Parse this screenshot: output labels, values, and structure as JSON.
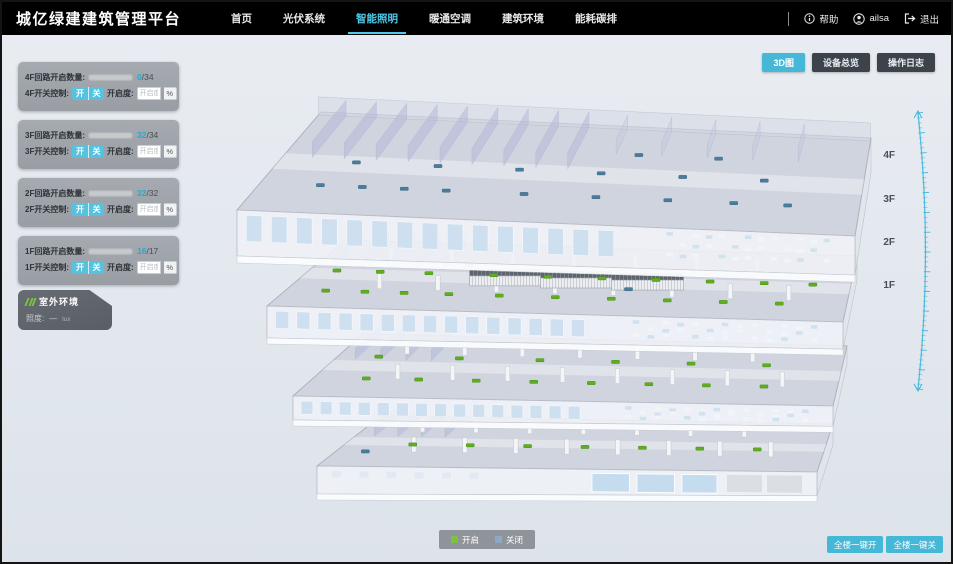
{
  "header": {
    "title": "城亿绿建建筑管理平台",
    "nav": [
      {
        "label": "首页",
        "active": false
      },
      {
        "label": "光伏系统",
        "active": false
      },
      {
        "label": "智能照明",
        "active": true
      },
      {
        "label": "暖通空调",
        "active": false
      },
      {
        "label": "建筑环境",
        "active": false
      },
      {
        "label": "能耗碳排",
        "active": false
      }
    ],
    "help_label": "帮助",
    "username": "ailsa",
    "logout_label": "退出"
  },
  "view_buttons": [
    {
      "label": "3D图",
      "active": true
    },
    {
      "label": "设备总览",
      "active": false
    },
    {
      "label": "操作日志",
      "active": false
    }
  ],
  "floor_panels": [
    {
      "count_label": "4F回路开启数量:",
      "count_open": "0",
      "count_rest": "/34",
      "progress": 0,
      "switch_label": "4F开关控制:",
      "on_label": "开",
      "off_label": "关",
      "dim_label": "开启度:",
      "dim_placeholder": "开启度",
      "percent_label": "%"
    },
    {
      "count_label": "3F回路开启数量:",
      "count_open": "32",
      "count_rest": "/34",
      "progress": 0.94,
      "switch_label": "3F开关控制:",
      "on_label": "开",
      "off_label": "关",
      "dim_label": "开启度:",
      "dim_placeholder": "开启度",
      "percent_label": "%"
    },
    {
      "count_label": "2F回路开启数量:",
      "count_open": "32",
      "count_rest": "/32",
      "progress": 1,
      "switch_label": "2F开关控制:",
      "on_label": "开",
      "off_label": "关",
      "dim_label": "开启度:",
      "dim_placeholder": "开启度",
      "percent_label": "%"
    },
    {
      "count_label": "1F回路开启数量:",
      "count_open": "16",
      "count_rest": "/17",
      "progress": 0.94,
      "switch_label": "1F开关控制:",
      "on_label": "开",
      "off_label": "关",
      "dim_label": "开启度:",
      "dim_placeholder": "开启度",
      "percent_label": "%"
    }
  ],
  "outdoor_panel": {
    "title": "室外环境",
    "metric_label": "照度:",
    "metric_value": "—",
    "metric_unit": "lux"
  },
  "floor_labels": [
    "4F",
    "3F",
    "2F",
    "1F"
  ],
  "legend": {
    "on_label": "开启",
    "off_label": "关闭"
  },
  "bottom_buttons": [
    {
      "label": "全楼一键开"
    },
    {
      "label": "全楼一键关"
    }
  ],
  "building": {
    "floors": [
      {
        "name": "4F",
        "lights_on": [],
        "lights_off": [
          [
            0.1,
            0.28
          ],
          [
            0.17,
            0.28
          ],
          [
            0.24,
            0.28
          ],
          [
            0.31,
            0.28
          ],
          [
            0.44,
            0.28
          ],
          [
            0.56,
            0.28
          ],
          [
            0.68,
            0.28
          ],
          [
            0.79,
            0.28
          ],
          [
            0.88,
            0.28
          ],
          [
            0.13,
            0.52
          ],
          [
            0.27,
            0.52
          ],
          [
            0.41,
            0.52
          ],
          [
            0.55,
            0.52
          ],
          [
            0.69,
            0.52
          ],
          [
            0.83,
            0.52
          ],
          [
            0.6,
            0.72
          ],
          [
            0.74,
            0.72
          ]
        ]
      },
      {
        "name": "3F",
        "lights_on": [
          [
            0.07,
            0.25
          ],
          [
            0.14,
            0.25
          ],
          [
            0.21,
            0.25
          ],
          [
            0.29,
            0.25
          ],
          [
            0.38,
            0.25
          ],
          [
            0.48,
            0.25
          ],
          [
            0.58,
            0.25
          ],
          [
            0.68,
            0.25
          ],
          [
            0.78,
            0.25
          ],
          [
            0.88,
            0.25
          ],
          [
            0.05,
            0.55
          ],
          [
            0.13,
            0.55
          ],
          [
            0.22,
            0.55
          ],
          [
            0.34,
            0.55
          ],
          [
            0.44,
            0.55
          ],
          [
            0.54,
            0.55
          ],
          [
            0.64,
            0.55
          ],
          [
            0.74,
            0.55
          ],
          [
            0.84,
            0.55
          ],
          [
            0.93,
            0.55
          ]
        ],
        "lights_off": [
          [
            0.6,
            0.4
          ],
          [
            0.28,
            0.68
          ]
        ]
      },
      {
        "name": "2F",
        "lights_on": [
          [
            0.1,
            0.3
          ],
          [
            0.2,
            0.3
          ],
          [
            0.31,
            0.3
          ],
          [
            0.42,
            0.3
          ],
          [
            0.53,
            0.3
          ],
          [
            0.64,
            0.3
          ],
          [
            0.75,
            0.3
          ],
          [
            0.86,
            0.3
          ],
          [
            0.08,
            0.65
          ],
          [
            0.24,
            0.65
          ],
          [
            0.4,
            0.65
          ],
          [
            0.55,
            0.65
          ],
          [
            0.7,
            0.65
          ],
          [
            0.85,
            0.65
          ]
        ],
        "lights_off": []
      },
      {
        "name": "1F",
        "lights_on": [
          [
            0.14,
            0.45
          ],
          [
            0.26,
            0.45
          ],
          [
            0.38,
            0.45
          ],
          [
            0.5,
            0.45
          ],
          [
            0.62,
            0.45
          ],
          [
            0.74,
            0.45
          ],
          [
            0.86,
            0.45
          ]
        ],
        "lights_off": [
          [
            0.06,
            0.3
          ]
        ]
      }
    ]
  },
  "colors": {
    "accent": "#45b8d8",
    "light_on": "#5fae1f",
    "light_off": "#4a7d9d",
    "legend_on": "#7cc142",
    "legend_off": "#8fa8c8",
    "scale": "#3ab5da"
  }
}
